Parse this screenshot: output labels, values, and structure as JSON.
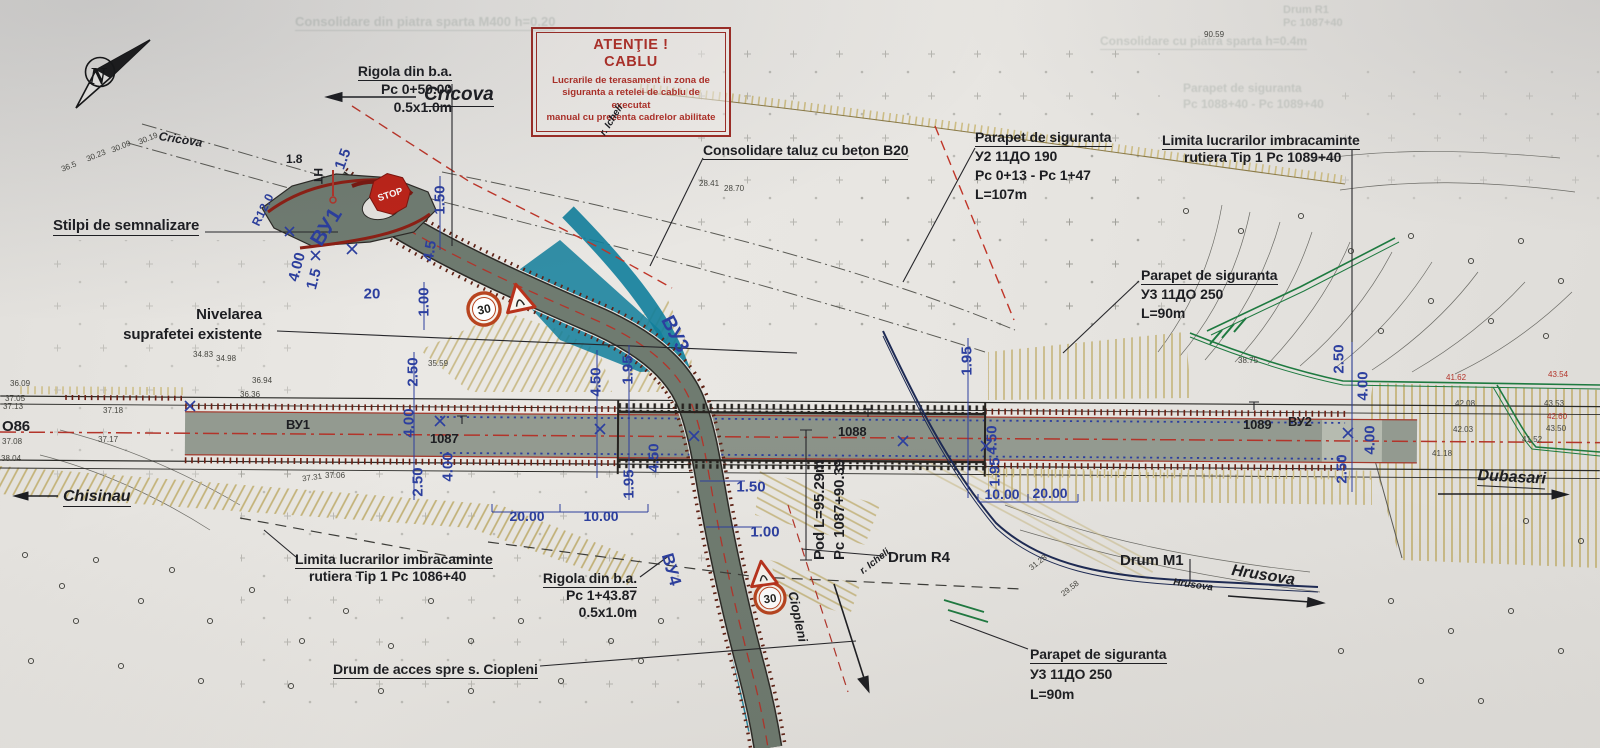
{
  "compass": {
    "n": "N"
  },
  "colors": {
    "paper": "#e8e6e2",
    "road_gray": "#939a90",
    "curve_gray": "#6f7b70",
    "river_teal": "#117e9b",
    "hatch_tan": "#c3b277",
    "comb_brown": "#6b2014",
    "line_red": "#b3342a",
    "dim_blue": "#2c3f9f",
    "utility_green": "#1e7a40",
    "sign_red": "#bf2318",
    "note_red": "#9e2d26",
    "ink": "#1d1e22"
  },
  "attention_note": {
    "title1": "ATENŢIE !",
    "title2": "CABLU",
    "body": [
      "Lucrarile de terasament in zona de",
      "siguranta a retelei de cablu de executat",
      "manual cu prezenta cadrelor abilitate"
    ]
  },
  "labels": [
    {
      "id": "direction-cricova",
      "cls": "place",
      "x": 424,
      "y": 84,
      "fs": 19,
      "lines": [
        {
          "t": "Cricova",
          "u": true
        }
      ]
    },
    {
      "id": "road-name-cricova",
      "cls": "place",
      "x": 160,
      "y": 129,
      "rot": 9,
      "fs": 12,
      "lines": [
        {
          "t": "Cricova"
        }
      ]
    },
    {
      "id": "note-rigola-top",
      "cls": "ann",
      "rx": 452,
      "y": 62,
      "lh": 18,
      "lines": [
        {
          "t": "Rigola din b.a.",
          "u": true
        },
        {
          "t": "Pc 0+50.00"
        },
        {
          "t": "0.5x1.0m"
        }
      ]
    },
    {
      "id": "note-consolidare-taluz",
      "cls": "ann",
      "x": 703,
      "y": 142,
      "lines": [
        {
          "t": "Consolidare taluz cu beton B20",
          "u": true
        }
      ]
    },
    {
      "id": "note-parapet-u2",
      "cls": "ann",
      "x": 975,
      "y": 128,
      "lh": 19,
      "lines": [
        {
          "t": "Parapet de siguranta",
          "u": true
        },
        {
          "t": "У2 11ДО 190"
        },
        {
          "t": "Pc 0+13 - Pc 1+47"
        },
        {
          "t": "L=107m"
        }
      ]
    },
    {
      "id": "note-limita-1089",
      "cls": "ann",
      "x": 1162,
      "y": 132,
      "lh": 17,
      "lines": [
        {
          "t": "Limita lucrarilor imbracaminte",
          "u": true
        },
        {
          "t": "rutiera Tip 1 Pc 1089+40",
          "ml": 22
        }
      ]
    },
    {
      "id": "note-parapet-u3-right",
      "cls": "ann",
      "x": 1141,
      "y": 266,
      "lh": 19,
      "lines": [
        {
          "t": "Parapet de siguranta",
          "u": true
        },
        {
          "t": "У3 11ДО 250"
        },
        {
          "t": "L=90m"
        }
      ]
    },
    {
      "id": "note-stilpi",
      "cls": "ann",
      "x": 53,
      "y": 217,
      "fs": 15,
      "lines": [
        {
          "t": "Stilpi de semnalizare",
          "u": true
        }
      ]
    },
    {
      "id": "note-nivelarea",
      "cls": "ann",
      "rx": 262,
      "y": 305,
      "fs": 15,
      "lh": 20,
      "lines": [
        {
          "t": "Nivelarea"
        },
        {
          "t": "suprafetei existente"
        }
      ]
    },
    {
      "id": "direction-chisinau",
      "cls": "place",
      "x": 63,
      "y": 488,
      "fs": 16,
      "lines": [
        {
          "t": "Chisinau",
          "u": true
        }
      ]
    },
    {
      "id": "road-index-o86",
      "cls": "ann",
      "x": 2,
      "y": 418,
      "fs": 15,
      "lines": [
        {
          "t": "О86"
        }
      ]
    },
    {
      "id": "road-bu1",
      "cls": "ann",
      "x": 286,
      "y": 417,
      "fs": 13,
      "lines": [
        {
          "t": "ВУ1"
        }
      ]
    },
    {
      "id": "km-1087",
      "cls": "ann",
      "x": 430,
      "y": 431,
      "fs": 13,
      "lines": [
        {
          "t": "1087"
        }
      ]
    },
    {
      "id": "km-1088",
      "cls": "ann",
      "x": 838,
      "y": 424,
      "fs": 13,
      "lines": [
        {
          "t": "1088"
        }
      ]
    },
    {
      "id": "km-1089",
      "cls": "ann",
      "x": 1243,
      "y": 417,
      "fs": 13,
      "lines": [
        {
          "t": "1089"
        }
      ]
    },
    {
      "id": "road-bu2",
      "cls": "ann",
      "x": 1288,
      "y": 414,
      "fs": 13,
      "lines": [
        {
          "t": "ВУ2"
        }
      ]
    },
    {
      "id": "axis-bu1-blue",
      "cls": "blue",
      "x": 306,
      "y": 238,
      "rot": -58,
      "fs": 21,
      "lines": [
        {
          "t": "ВУ1"
        }
      ]
    },
    {
      "id": "radius-r12",
      "cls": "blue",
      "x": 249,
      "y": 222,
      "rot": -64,
      "fs": 12,
      "lines": [
        {
          "t": "R12.0"
        }
      ]
    },
    {
      "id": "axis-bu3-blue",
      "cls": "blue",
      "x": 676,
      "y": 312,
      "rot": 63,
      "fs": 20,
      "lines": [
        {
          "t": "ВУ3"
        }
      ]
    },
    {
      "id": "axis-bu4-blue",
      "cls": "blue",
      "x": 676,
      "y": 551,
      "rot": 74,
      "fs": 17,
      "lines": [
        {
          "t": "ВУ4"
        }
      ]
    },
    {
      "id": "mark-ht",
      "cls": "ann",
      "x": 325,
      "y": 168,
      "rot": 90,
      "fs": 12,
      "lines": [
        {
          "t": "HT"
        }
      ]
    },
    {
      "id": "mark-1-8",
      "cls": "ann",
      "x": 286,
      "y": 152,
      "fs": 12,
      "lines": [
        {
          "t": "1.8"
        }
      ]
    },
    {
      "id": "note-pod",
      "cls": "ann",
      "x": 810,
      "y": 560,
      "rot": -90,
      "fs": 15,
      "lh": 20,
      "lines": [
        {
          "t": "Pod  L=95.29m"
        },
        {
          "t": "Pc 1087+90.39"
        }
      ]
    },
    {
      "id": "note-drum-r4",
      "cls": "ann",
      "x": 888,
      "y": 549,
      "fs": 15,
      "lines": [
        {
          "t": "Drum R4"
        }
      ]
    },
    {
      "id": "note-drum-m1",
      "cls": "ann",
      "x": 1120,
      "y": 552,
      "fs": 15,
      "lines": [
        {
          "t": "Drum M1"
        }
      ]
    },
    {
      "id": "road-name-hrusova",
      "cls": "place",
      "x": 1174,
      "y": 577,
      "rot": 8,
      "fs": 10,
      "lines": [
        {
          "t": "Hrusova"
        }
      ]
    },
    {
      "id": "direction-hrusova",
      "cls": "place",
      "x": 1233,
      "y": 562,
      "rot": 9,
      "fs": 16,
      "lines": [
        {
          "t": "Hrusova"
        }
      ]
    },
    {
      "id": "direction-dubasari",
      "cls": "place",
      "x": 1478,
      "y": 467,
      "rot": 3,
      "fs": 16,
      "lines": [
        {
          "t": "Dubasari",
          "u": true
        }
      ]
    },
    {
      "id": "note-limita-1086",
      "cls": "ann",
      "x": 295,
      "y": 551,
      "lh": 17,
      "lines": [
        {
          "t": "Limita lucrarilor imbracaminte",
          "u": true
        },
        {
          "t": "rutiera Tip 1 Pc 1086+40",
          "ml": 14
        }
      ]
    },
    {
      "id": "note-rigola-bottom",
      "cls": "ann",
      "rx": 637,
      "y": 570,
      "lh": 17,
      "lines": [
        {
          "t": "Rigola din b.a.",
          "u": true
        },
        {
          "t": "Pc 1+43.87"
        },
        {
          "t": "0.5x1.0m"
        }
      ]
    },
    {
      "id": "note-drum-acces",
      "cls": "ann",
      "x": 333,
      "y": 661,
      "lines": [
        {
          "t": "Drum de acces spre s. Ciopleni",
          "u": true
        }
      ]
    },
    {
      "id": "note-parapet-u3-bottom",
      "cls": "ann",
      "x": 1030,
      "y": 644,
      "lh": 20,
      "lines": [
        {
          "t": "Parapet de siguranta",
          "u": true
        },
        {
          "t": "У3 11ДО 250"
        },
        {
          "t": "L=90m"
        }
      ]
    },
    {
      "id": "direction-ciopleni",
      "cls": "place",
      "x": 800,
      "y": 590,
      "rot": 78,
      "fs": 13,
      "lines": [
        {
          "t": "Ciopleni"
        }
      ]
    },
    {
      "id": "river-icheli-top",
      "cls": "place",
      "x": 598,
      "y": 132,
      "rot": -58,
      "fs": 10,
      "lines": [
        {
          "t": "r. Icheli"
        }
      ]
    },
    {
      "id": "river-icheli-mid",
      "cls": "place",
      "x": 858,
      "y": 568,
      "rot": -38,
      "fs": 10,
      "lines": [
        {
          "t": "r. Icheli"
        }
      ]
    },
    {
      "id": "bleed-note-1",
      "cls": "faint",
      "x": 295,
      "y": 14,
      "fs": 13,
      "lines": [
        {
          "t": "Consolidare din piatra sparta M400 h=0.20",
          "u": true
        }
      ]
    },
    {
      "id": "bleed-note-2",
      "cls": "faint",
      "x": 1283,
      "y": 4,
      "fs": 11,
      "lh": 13,
      "lines": [
        {
          "t": "Drum R1"
        },
        {
          "t": "Pc 1087+40"
        }
      ]
    },
    {
      "id": "bleed-note-3",
      "cls": "faint",
      "x": 1100,
      "y": 34,
      "fs": 12,
      "lines": [
        {
          "t": "Consolidare cu piatra sparta h=0.4m",
          "u": true
        }
      ]
    },
    {
      "id": "bleed-note-4",
      "cls": "faint",
      "x": 1183,
      "y": 80,
      "fs": 12,
      "lh": 16,
      "lines": [
        {
          "t": "Parapet de siguranta"
        },
        {
          "t": "Pc 1088+40 - Pc 1089+40"
        }
      ]
    }
  ],
  "dimensions": [
    {
      "t": "1.50",
      "x": 440,
      "y": 200,
      "r": -90
    },
    {
      "t": "1.00",
      "x": 424,
      "y": 302,
      "r": -90
    },
    {
      "t": "2.50",
      "x": 413,
      "y": 372,
      "r": -90
    },
    {
      "t": "4.00",
      "x": 409,
      "y": 423,
      "r": -90
    },
    {
      "t": "4.00",
      "x": 448,
      "y": 467,
      "r": -90
    },
    {
      "t": "2.50",
      "x": 418,
      "y": 482,
      "r": -90
    },
    {
      "t": "4.50",
      "x": 596,
      "y": 382,
      "r": -90
    },
    {
      "t": "1.95",
      "x": 628,
      "y": 370,
      "r": -90
    },
    {
      "t": "4.50",
      "x": 654,
      "y": 458,
      "r": -90
    },
    {
      "t": "1.95",
      "x": 629,
      "y": 484,
      "r": -90
    },
    {
      "t": "20.00",
      "x": 527,
      "y": 516,
      "r": 0
    },
    {
      "t": "10.00",
      "x": 601,
      "y": 516,
      "r": 0
    },
    {
      "t": "1.50",
      "x": 751,
      "y": 487,
      "r": 0
    },
    {
      "t": "1.00",
      "x": 765,
      "y": 532,
      "r": 0
    },
    {
      "t": "1.95",
      "x": 967,
      "y": 361,
      "r": -90
    },
    {
      "t": "4.50",
      "x": 992,
      "y": 440,
      "r": -90
    },
    {
      "t": "1.95",
      "x": 995,
      "y": 472,
      "r": -90
    },
    {
      "t": "10.00",
      "x": 1002,
      "y": 494,
      "r": 0
    },
    {
      "t": "20.00",
      "x": 1050,
      "y": 493,
      "r": 0
    },
    {
      "t": "2.50",
      "x": 1339,
      "y": 359,
      "r": -90
    },
    {
      "t": "4.00",
      "x": 1363,
      "y": 386,
      "r": -90
    },
    {
      "t": "4.00",
      "x": 1370,
      "y": 440,
      "r": -90
    },
    {
      "t": "2.50",
      "x": 1342,
      "y": 469,
      "r": -90
    },
    {
      "t": "20",
      "x": 372,
      "y": 294,
      "r": 0
    },
    {
      "t": "4.00",
      "x": 297,
      "y": 267,
      "r": -75
    },
    {
      "t": "1.5",
      "x": 343,
      "y": 159,
      "r": -70
    },
    {
      "t": "1.5",
      "x": 314,
      "y": 279,
      "r": -75
    },
    {
      "t": "4.5",
      "x": 430,
      "y": 251,
      "r": -80
    }
  ],
  "elevations": [
    {
      "v": "36.09",
      "x": 10,
      "y": 379
    },
    {
      "v": "37.05",
      "x": 5,
      "y": 394
    },
    {
      "v": "37.13",
      "x": 3,
      "y": 402
    },
    {
      "v": "37.08",
      "x": 2,
      "y": 437
    },
    {
      "v": "38.04",
      "x": 1,
      "y": 454
    },
    {
      "v": "37.18",
      "x": 103,
      "y": 406
    },
    {
      "v": "37.17",
      "x": 98,
      "y": 435
    },
    {
      "v": "37.31",
      "x": 302,
      "y": 473,
      "r": -8
    },
    {
      "v": "37.06",
      "x": 325,
      "y": 471
    },
    {
      "v": "34.98",
      "x": 216,
      "y": 354
    },
    {
      "v": "34.83",
      "x": 193,
      "y": 350
    },
    {
      "v": "36.94",
      "x": 252,
      "y": 376
    },
    {
      "v": "36.36",
      "x": 240,
      "y": 390
    },
    {
      "v": "35.59",
      "x": 428,
      "y": 359
    },
    {
      "v": "28.41",
      "x": 699,
      "y": 179
    },
    {
      "v": "28.70",
      "x": 724,
      "y": 184
    },
    {
      "v": "38.75",
      "x": 1238,
      "y": 356
    },
    {
      "v": "41.62",
      "x": 1446,
      "y": 373,
      "c": "r"
    },
    {
      "v": "43.54",
      "x": 1548,
      "y": 370,
      "c": "r"
    },
    {
      "v": "42.60",
      "x": 1547,
      "y": 412,
      "c": "r"
    },
    {
      "v": "42.08",
      "x": 1455,
      "y": 399
    },
    {
      "v": "43.53",
      "x": 1544,
      "y": 399
    },
    {
      "v": "42.03",
      "x": 1453,
      "y": 425
    },
    {
      "v": "43.50",
      "x": 1546,
      "y": 424
    },
    {
      "v": "41.52",
      "x": 1522,
      "y": 435
    },
    {
      "v": "41.18",
      "x": 1432,
      "y": 449
    },
    {
      "v": "31.28",
      "x": 1028,
      "y": 558,
      "r": -38
    },
    {
      "v": "29.58",
      "x": 1060,
      "y": 584,
      "r": -38
    },
    {
      "v": "30.23",
      "x": 86,
      "y": 151,
      "r": -22
    },
    {
      "v": "30.09",
      "x": 111,
      "y": 142,
      "r": -22
    },
    {
      "v": "30.19",
      "x": 138,
      "y": 134,
      "r": -22
    },
    {
      "v": "36.5",
      "x": 61,
      "y": 162,
      "r": -22
    },
    {
      "v": "90.59",
      "x": 1204,
      "y": 30
    }
  ],
  "signs": {
    "stop": "STOP",
    "speed_limit": "30"
  },
  "vegetation": [
    [
      25,
      555
    ],
    [
      62,
      586
    ],
    [
      96,
      560
    ],
    [
      76,
      621
    ],
    [
      141,
      601
    ],
    [
      172,
      570
    ],
    [
      210,
      621
    ],
    [
      252,
      590
    ],
    [
      302,
      641
    ],
    [
      346,
      611
    ],
    [
      391,
      646
    ],
    [
      431,
      601
    ],
    [
      471,
      641
    ],
    [
      521,
      621
    ],
    [
      611,
      641
    ],
    [
      661,
      621
    ],
    [
      31,
      661
    ],
    [
      121,
      666
    ],
    [
      201,
      681
    ],
    [
      291,
      686
    ],
    [
      381,
      691
    ],
    [
      471,
      691
    ],
    [
      561,
      681
    ],
    [
      641,
      661
    ],
    [
      1186,
      211
    ],
    [
      1241,
      231
    ],
    [
      1301,
      216
    ],
    [
      1351,
      251
    ],
    [
      1411,
      236
    ],
    [
      1471,
      261
    ],
    [
      1521,
      241
    ],
    [
      1561,
      281
    ],
    [
      1431,
      301
    ],
    [
      1491,
      321
    ],
    [
      1546,
      336
    ],
    [
      1381,
      331
    ],
    [
      1391,
      601
    ],
    [
      1451,
      631
    ],
    [
      1511,
      611
    ],
    [
      1561,
      651
    ],
    [
      1421,
      681
    ],
    [
      1481,
      701
    ],
    [
      1341,
      651
    ],
    [
      1526,
      521
    ],
    [
      1581,
      541
    ]
  ]
}
